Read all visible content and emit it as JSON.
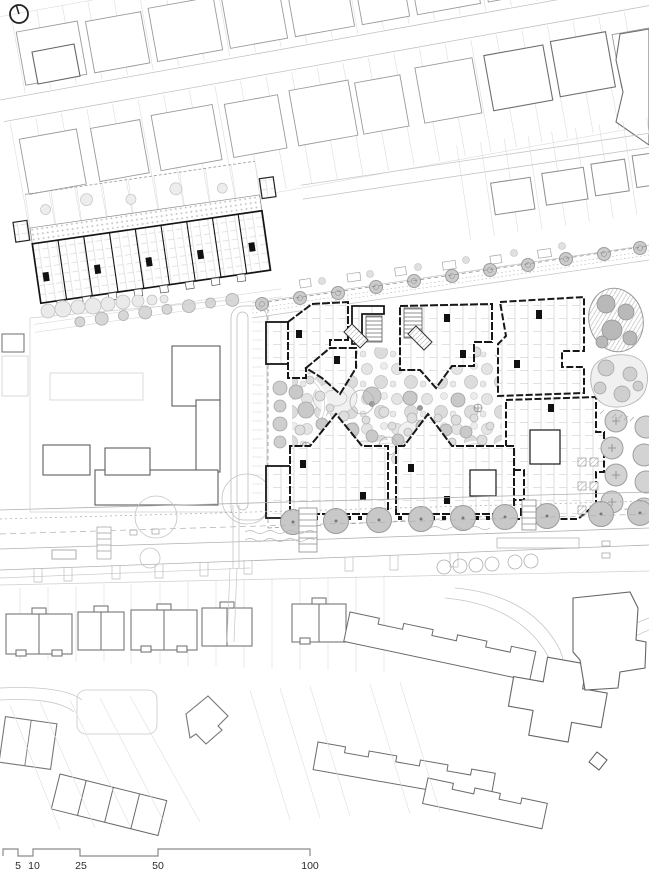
{
  "drawing": {
    "kind": "architectural masterplan site plan",
    "orientation": {
      "symbol": "north-arrow"
    }
  },
  "scale_bar": {
    "units": [
      "5",
      "10",
      "25",
      "50",
      "100"
    ]
  },
  "palette": {
    "paper": "#ffffff",
    "new_building_ink": "#161616",
    "context_building": "#8f8f8f",
    "context_dark": "#666666",
    "plot_line": "#d8d8d8",
    "road_line": "#b0b0b0",
    "tree_fill": "#cccccc",
    "tree_outline": "#9e9e9e",
    "landscape": "#e7e7e7"
  }
}
